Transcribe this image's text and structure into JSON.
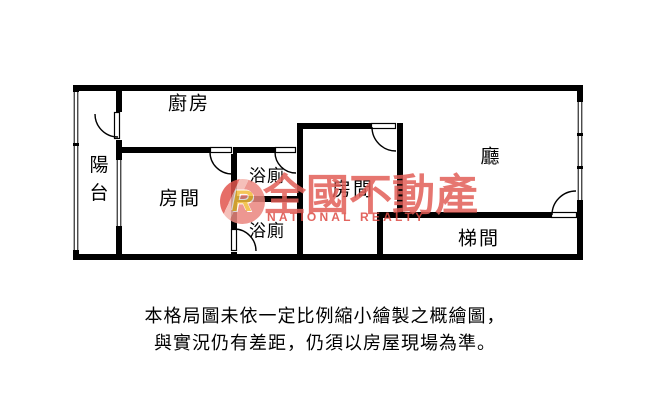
{
  "floor_plan": {
    "rooms": {
      "kitchen": {
        "label": "廚房"
      },
      "balcony": {
        "label": "陽台"
      },
      "room1": {
        "label": "房間"
      },
      "bath_upper": {
        "label": "浴廁"
      },
      "bath_lower": {
        "label": "浴廁"
      },
      "room2": {
        "label": "房間"
      },
      "living": {
        "label": "廳"
      },
      "stairwell": {
        "label": "梯間"
      }
    },
    "wall_color": "#000000",
    "background_color": "#ffffff"
  },
  "watermark": {
    "logo_letter": "R",
    "brand": "全國不動產",
    "brand_en": "NATIONAL REALTY",
    "brand_color": "#e25f58",
    "logo_color": "#ea867e",
    "logo_letter_color": "#f3bb3a"
  },
  "disclaimer": {
    "line1": "本格局圖未依一定比例縮小繪製之概繪圖，",
    "line2": "與實況仍有差距，仍須以房屋現場為準。"
  }
}
